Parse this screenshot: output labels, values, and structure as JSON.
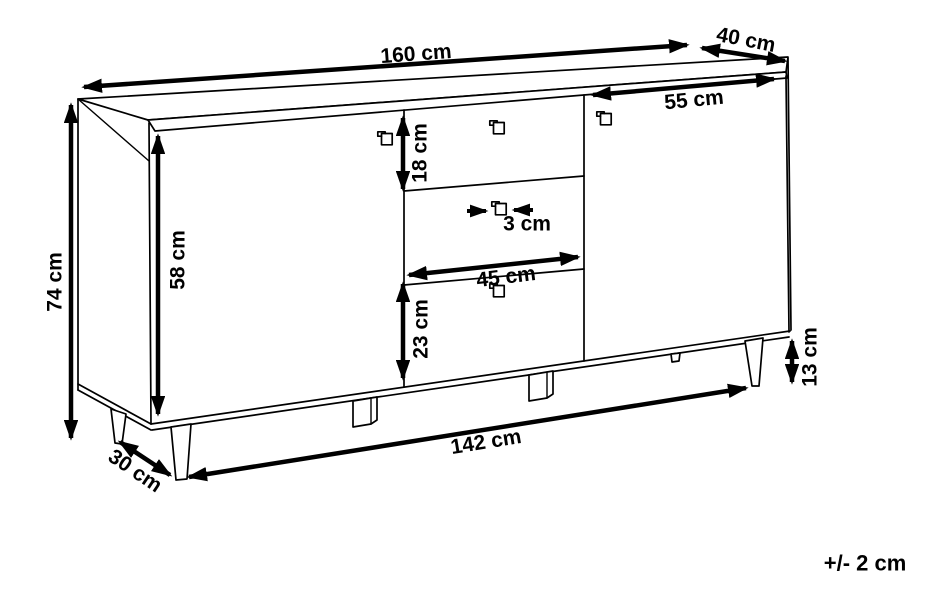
{
  "diagram": {
    "subject": "sideboard-technical-drawing",
    "unit": "cm",
    "tolerance_note": "+/- 2 cm",
    "dimensions": {
      "top_width": {
        "label": "160 cm",
        "value": 160,
        "unit": "cm"
      },
      "top_depth": {
        "label": "40 cm",
        "value": 40,
        "unit": "cm"
      },
      "right_door_width": {
        "label": "55 cm",
        "value": 55,
        "unit": "cm"
      },
      "total_height": {
        "label": "74 cm",
        "value": 74,
        "unit": "cm"
      },
      "door_height": {
        "label": "58 cm",
        "value": 58,
        "unit": "cm"
      },
      "top_drawer_height": {
        "label": "18 cm",
        "value": 18,
        "unit": "cm"
      },
      "handle_depth": {
        "label": "3 cm",
        "value": 3,
        "unit": "cm"
      },
      "drawer_width": {
        "label": "45 cm",
        "value": 45,
        "unit": "cm"
      },
      "lower_drawer_height": {
        "label": "23 cm",
        "value": 23,
        "unit": "cm"
      },
      "leg_height": {
        "label": "13 cm",
        "value": 13,
        "unit": "cm"
      },
      "base_width": {
        "label": "142 cm",
        "value": 142,
        "unit": "cm"
      },
      "base_depth": {
        "label": "30 cm",
        "value": 30,
        "unit": "cm"
      }
    }
  }
}
